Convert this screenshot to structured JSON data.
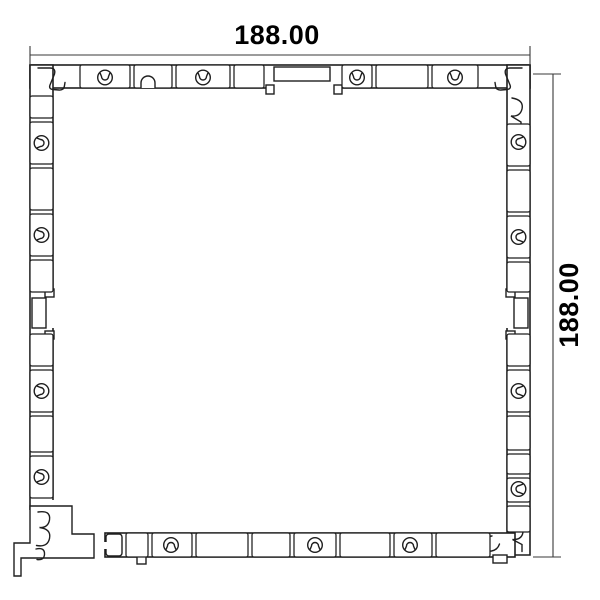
{
  "style": {
    "background": "#ffffff",
    "line_color": "#1f1f1f",
    "dim_line_color": "#3a3a3a",
    "text_color": "#000000"
  },
  "dimensions": {
    "width": {
      "label": "188.00",
      "value": 188.0
    },
    "height": {
      "label": "188.00",
      "value": 188.0
    }
  },
  "profile": {
    "description": "Square hollow frame extrusion profile cross-section",
    "screw_port_counts": {
      "top": 4,
      "bottom": 3,
      "left": 4,
      "right": 4
    },
    "groove_counts": {
      "top": 1,
      "left": 1,
      "right": 1
    }
  }
}
